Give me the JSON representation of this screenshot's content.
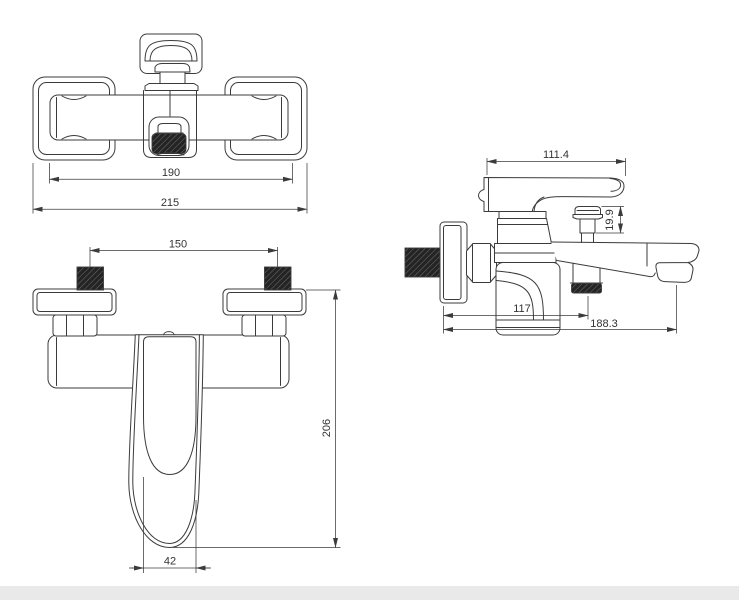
{
  "colors": {
    "background": "#ffffff",
    "line_color": "#3b3b3b",
    "text_color": "#333333",
    "footer_strip": "#e9e9e9"
  },
  "views": {
    "top": {
      "dim_body_width": "190",
      "dim_overall_width": "215"
    },
    "front": {
      "dim_inlet_spacing": "150",
      "dim_overall_height": "206",
      "dim_handle_width": "42"
    },
    "side": {
      "dim_handle_length": "111.4",
      "dim_diverter_height": "19.9",
      "dim_wall_to_shower_outlet": "117",
      "dim_wall_to_spout_tip": "188.3"
    }
  }
}
